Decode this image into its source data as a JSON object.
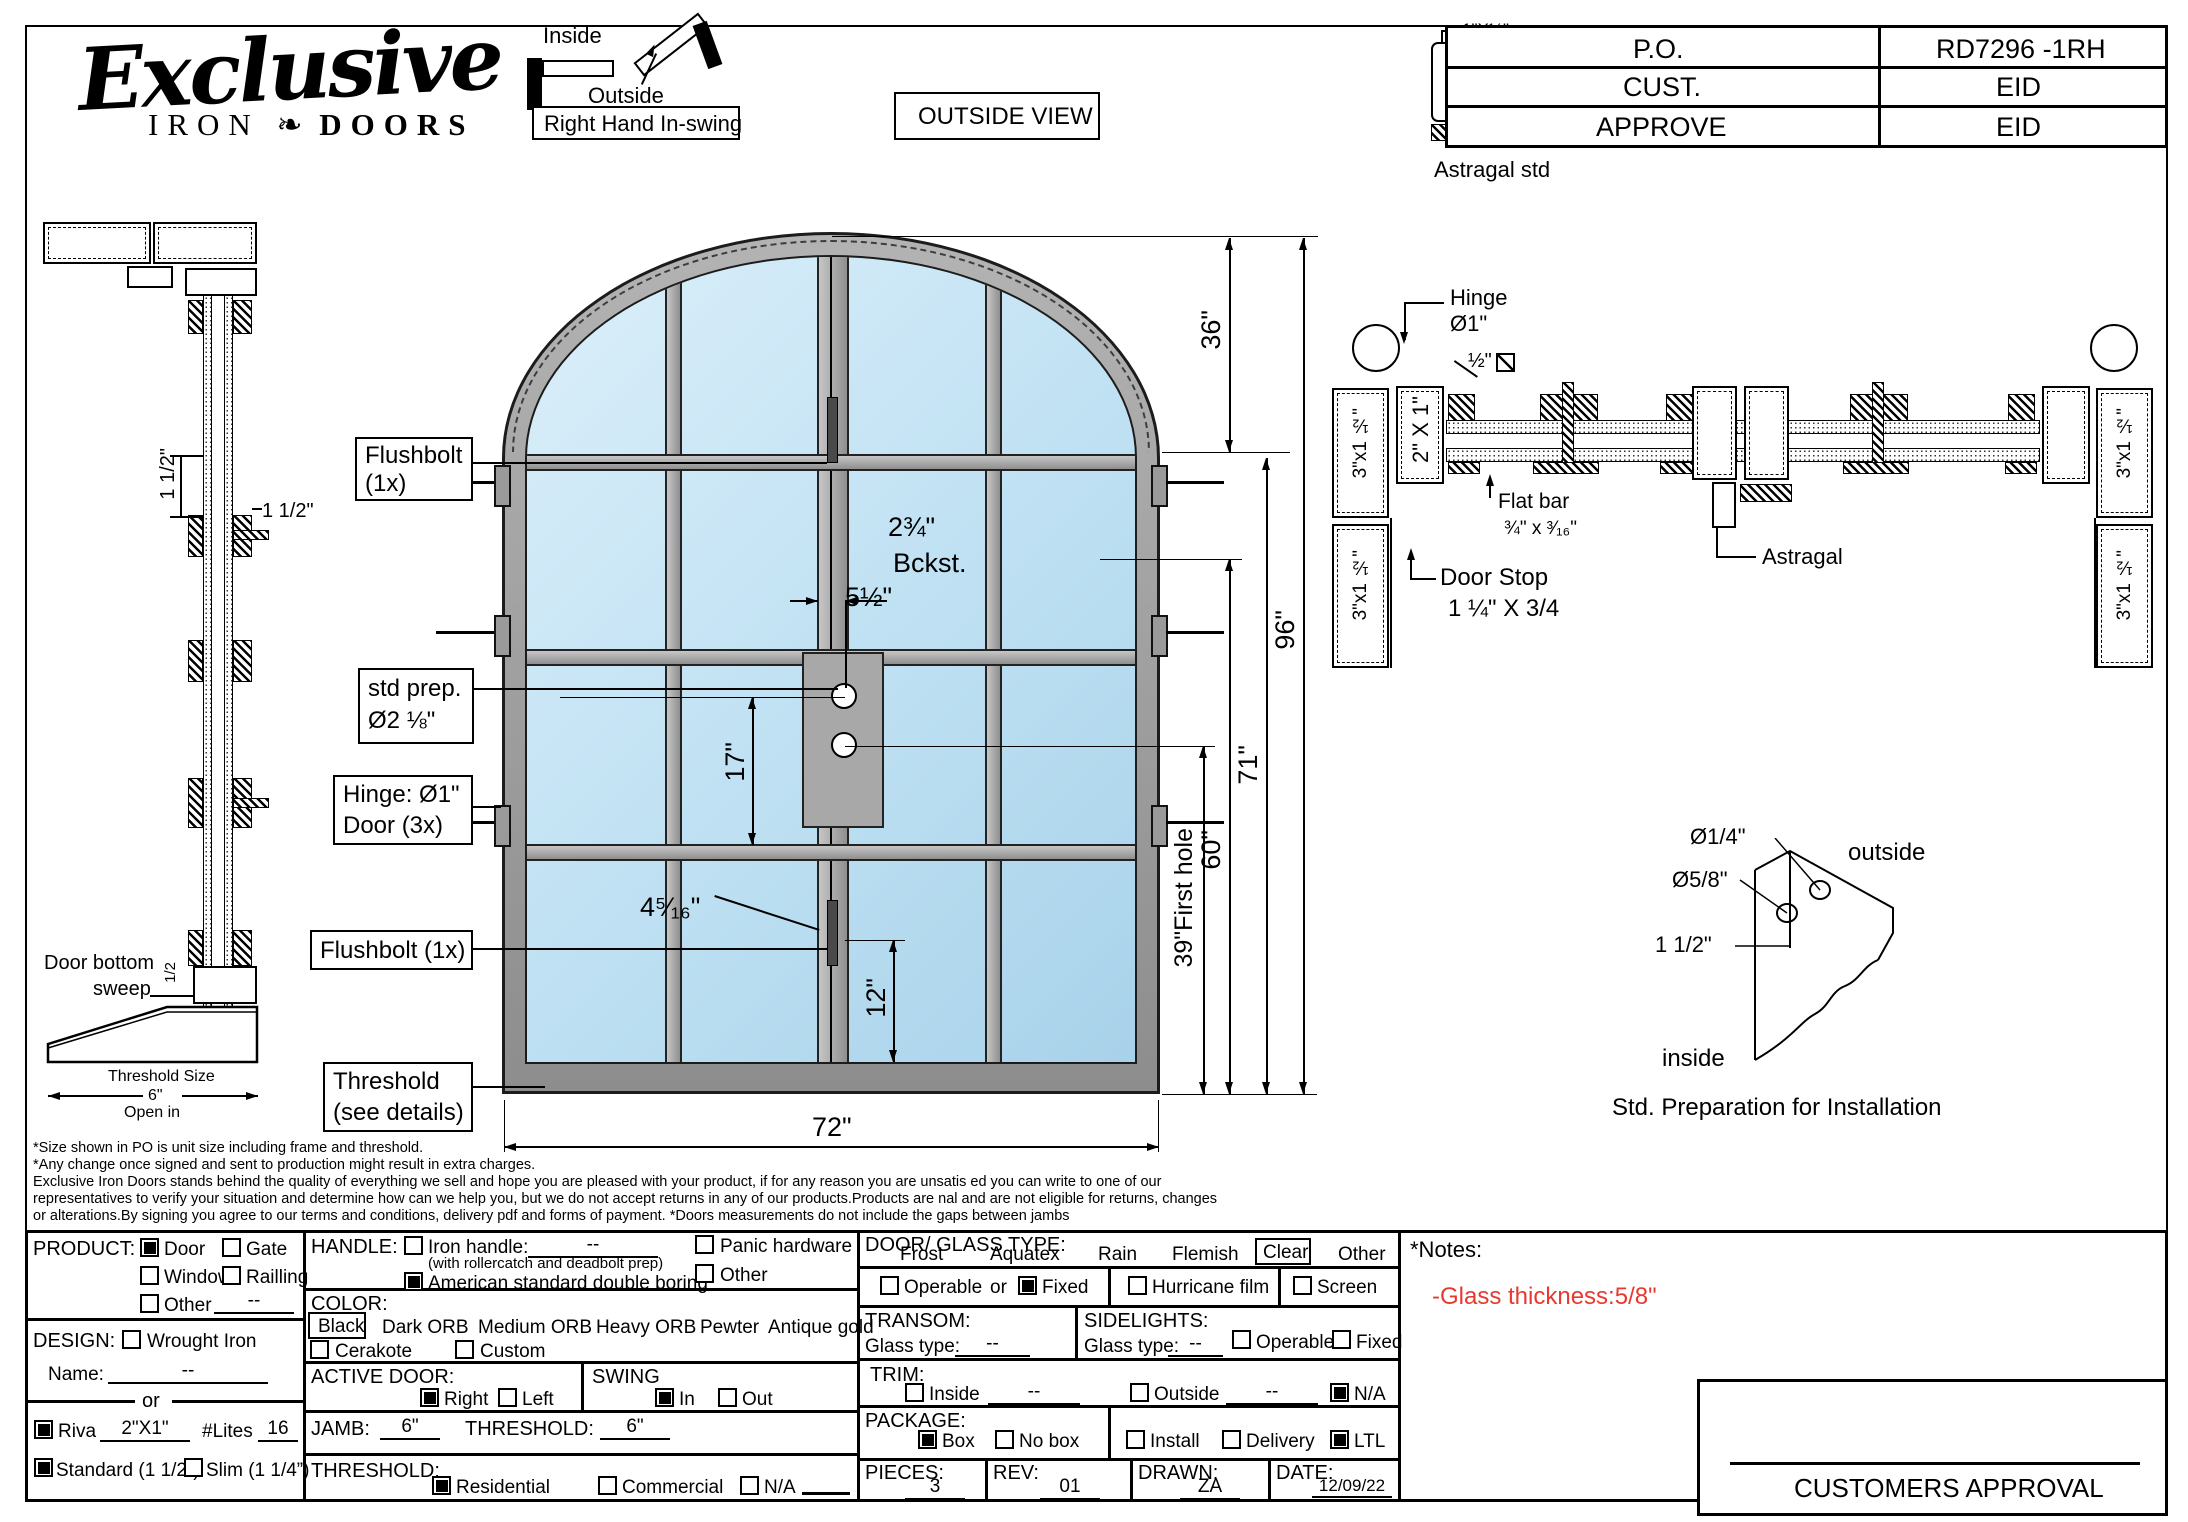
{
  "logo": {
    "script": "Exclusive",
    "iron": "IRON",
    "doors": "DOORS"
  },
  "swing_diagram": {
    "inside": "Inside",
    "outside": "Outside",
    "label": "Right Hand In-swing"
  },
  "view_label": "OUTSIDE VIEW",
  "title_block": {
    "po_label": "P.O.",
    "po_value": "RD7296 -1RH",
    "cust_label": "CUST.",
    "cust_value": "EID",
    "approve_label": "APPROVE",
    "approve_value": "EID"
  },
  "astragal_detail": {
    "dim": "1\"X½\"",
    "sq_bar": "Sq. Bar 5/8\"",
    "flat_bar": "Flat bar",
    "flat_bar_size": "1¼\"x³⁄₁₆\"",
    "caption": "Astragal std"
  },
  "jamb_section": {
    "dim_rot": "1 1/2\"",
    "dim": "1 1/2\"",
    "sweep_line1": "Door bottom",
    "sweep_line2": "sweep",
    "half": "1/2",
    "threshold_title": "Threshold Size",
    "threshold_size": "6\"",
    "open_in": "Open in"
  },
  "door_view": {
    "callout_flushbolt_top_1": "Flushbolt",
    "callout_flushbolt_top_2": "(1x)",
    "callout_stdprep_1": "std prep.",
    "callout_stdprep_2": "Ø2 ⅛\"",
    "callout_hinge_1": "Hinge: Ø1\"",
    "callout_hinge_2": "Door (3x)",
    "callout_flushbolt_bottom": "Flushbolt (1x)",
    "callout_threshold_1": "Threshold",
    "callout_threshold_2": "(see details)",
    "dim_backset": "2¾\"",
    "dim_backset_label": "Bckst.",
    "dim_5_5": "5½\"",
    "dim_17": "17\"",
    "dim_4_5_16": "4⁵⁄₁₆\"",
    "dim_12": "12\"",
    "dim_width": "72\"",
    "dim_36": "36\"",
    "dim_96": "96\"",
    "dim_71": "71\"",
    "dim_60": "60\"",
    "dim_first_hole": "39\"First hole"
  },
  "head_section": {
    "hinge_label_1": "Hinge",
    "hinge_label_2": "Ø1\"",
    "half_square": "½\"",
    "jamb_size_top": "3\"x1 ½\"",
    "jamb_size_bottom": "3\"x1 ½\"",
    "jamb_size_top_r": "3\"x1 ½\"",
    "jamb_size_bottom_r": "3\"x1 ½\"",
    "tube_size": "2\" X 1\"",
    "flat_bar_1": "Flat bar",
    "flat_bar_2": "¾\" x ³⁄₁₆\"",
    "door_stop_1": "Door Stop",
    "door_stop_2": "1 ¼\" X 3/4",
    "astragal": "Astragal"
  },
  "install_detail": {
    "hole_small": "Ø1/4\"",
    "hole_large": "Ø5/8\"",
    "offset": "1 1/2\"",
    "outside": "outside",
    "inside": "inside",
    "caption": "Std. Preparation for Installation"
  },
  "disclaimer": {
    "l1": "*Size shown in PO is unit size including frame and threshold.",
    "l2": "*Any change once signed and sent to production might result in extra charges.",
    "l3": "Exclusive Iron Doors stands behind the quality of everything we sell and hope you are pleased with your product, if for any reason you are unsatis  ed you can write to one of our",
    "l4": "representatives to verify your situation and determine how can we help you, but we do not accept returns in any of our products.Products are   nal and are not eligible for returns, changes",
    "l5": "or alterations.By signing you agree to our terms and conditions, delivery pdf and forms of payment. *Doors measurements do not include the gaps between jambs"
  },
  "form": {
    "product": {
      "label": "PRODUCT:",
      "door": "Door",
      "gate": "Gate",
      "window": "Window",
      "railing": "Railling",
      "other": "Other",
      "other_value": "--"
    },
    "design": {
      "label": "DESIGN:",
      "wrought_iron": "Wrought Iron",
      "name_label": "Name:",
      "name_value": "--",
      "or": "or",
      "riva": "Riva",
      "riva_value": "2\"X1\"",
      "lites_label": "#Lites",
      "lites_value": "16",
      "standard": "Standard (1 1/2”)",
      "slim": "Slim (1 1/4”)"
    },
    "handle": {
      "label": "HANDLE:",
      "iron_handle": "Iron handle:",
      "iron_handle_value": "--",
      "iron_handle_note": "(with rollercatch and deadbolt prep)",
      "american": "American standard double boring",
      "panic": "Panic hardware",
      "other": "Other"
    },
    "color": {
      "label": "COLOR:",
      "black": "Black",
      "dark_orb": "Dark ORB",
      "medium_orb": "Medium ORB",
      "heavy_orb": "Heavy ORB",
      "pewter": "Pewter",
      "antique_gold": "Antique gold",
      "cerakote": "Cerakote",
      "custom": "Custom"
    },
    "active_door": {
      "label": "ACTIVE DOOR:",
      "right": "Right",
      "left": "Left"
    },
    "swing": {
      "label": "SWING",
      "in": "In",
      "out": "Out"
    },
    "jamb": {
      "label": "JAMB:",
      "value": "6\"",
      "threshold_label": "THRESHOLD:",
      "threshold_value": "6\""
    },
    "threshold": {
      "label": "THRESHOLD:",
      "residential": "Residential",
      "commercial": "Commercial",
      "na": "N/A"
    },
    "glass": {
      "label": "DOOR/ GLASS TYPE:",
      "frost": "Frost",
      "aquatex": "Aquatex",
      "rain": "Rain",
      "flemish": "Flemish",
      "clear": "Clear",
      "other": "Other",
      "operable": "Operable",
      "or": "or",
      "fixed": "Fixed",
      "hurricane": "Hurricane film",
      "screen": "Screen"
    },
    "transom": {
      "label": "TRANSOM:",
      "glass_type": "Glass type:",
      "value": "--"
    },
    "sidelights": {
      "label": "SIDELIGHTS:",
      "glass_type": "Glass type:",
      "value": "--",
      "operable": "Operable",
      "fixed": "Fixed"
    },
    "trim": {
      "label": "TRIM:",
      "inside": "Inside",
      "inside_value": "--",
      "outside": "Outside",
      "outside_value": "--",
      "na": "N/A"
    },
    "package": {
      "label": "PACKAGE:",
      "box": "Box",
      "no_box": "No box",
      "install": "Install",
      "delivery": "Delivery",
      "ltl": "LTL"
    },
    "pieces": {
      "label": "PIECES:",
      "value": "3"
    },
    "rev": {
      "label": "REV:",
      "value": "01"
    },
    "drawn": {
      "label": "DRAWN:",
      "value": "ZA"
    },
    "date": {
      "label": "DATE:",
      "value": "12/09/22"
    },
    "notes": {
      "label": "*Notes:",
      "glass_thickness": "-Glass thickness:5/8\""
    },
    "approval": {
      "label": "CUSTOMERS APPROVAL"
    }
  }
}
